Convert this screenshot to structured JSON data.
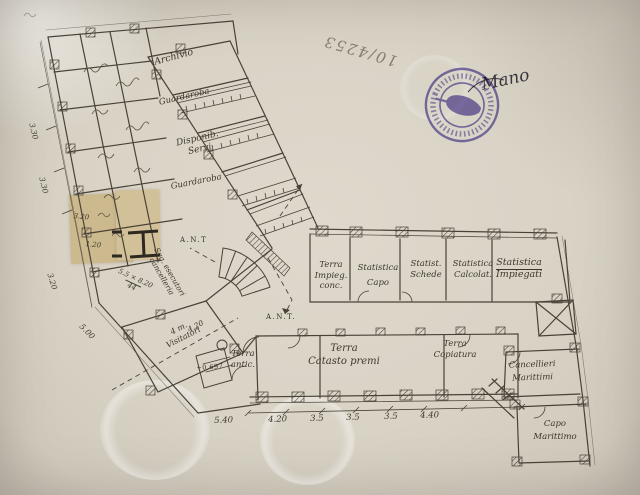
{
  "handwriting": {
    "archive_number": "10/4253",
    "name": "Mano"
  },
  "stamp": {
    "ink_color": "#6c5cb4"
  },
  "patch_color": "#ccb98e",
  "plan_labels": {
    "archivio": "Archivio",
    "guardaroba_upper": "Guardaroba",
    "disponibile": [
      "Disponib.",
      "Servi"
    ],
    "guardaroba_lower": "Guardaroba",
    "ant_small": "A.N.T",
    "ant_corridor": "A.N.T.",
    "terra_impiegati": [
      "Terra",
      "Impieg.",
      "conc."
    ],
    "statistica_capo": [
      "Statistica",
      "Capo"
    ],
    "statistica_schede": [
      "Statist.",
      "Schede"
    ],
    "statistica_calcolatori": [
      "Statistica",
      "Calcolat."
    ],
    "statistica_impiegati": [
      "Statistica",
      "Impiegati"
    ],
    "terra_anticamera": [
      "Terra",
      "antic."
    ],
    "terra_catasto": [
      "Terra",
      "Catasto premi"
    ],
    "terra_copiatura": [
      "Terra",
      "Copiatura"
    ],
    "cancellieri_marittimi": [
      "Cancellieri",
      "Marittimi"
    ],
    "capo_marittimo": [
      "Capo",
      "Marittimo"
    ],
    "visitatori": [
      "4 m.",
      "Visitatori"
    ],
    "segreteria": [
      "Seg. esecutori",
      "cancelleria"
    ],
    "segreteria_fraction": [
      "5.5 × 8.20",
      "44"
    ],
    "level_mark": "+0.697"
  },
  "dimensions": {
    "bottom_chain": [
      "5.40",
      "4.20",
      "3.5",
      "3.5",
      "3.5",
      "4.40"
    ],
    "left_chain": [
      "3.30",
      "3.30",
      "3.20",
      "5.00"
    ],
    "patch": [
      "3.20",
      "1.20"
    ],
    "wing": "4.20"
  }
}
